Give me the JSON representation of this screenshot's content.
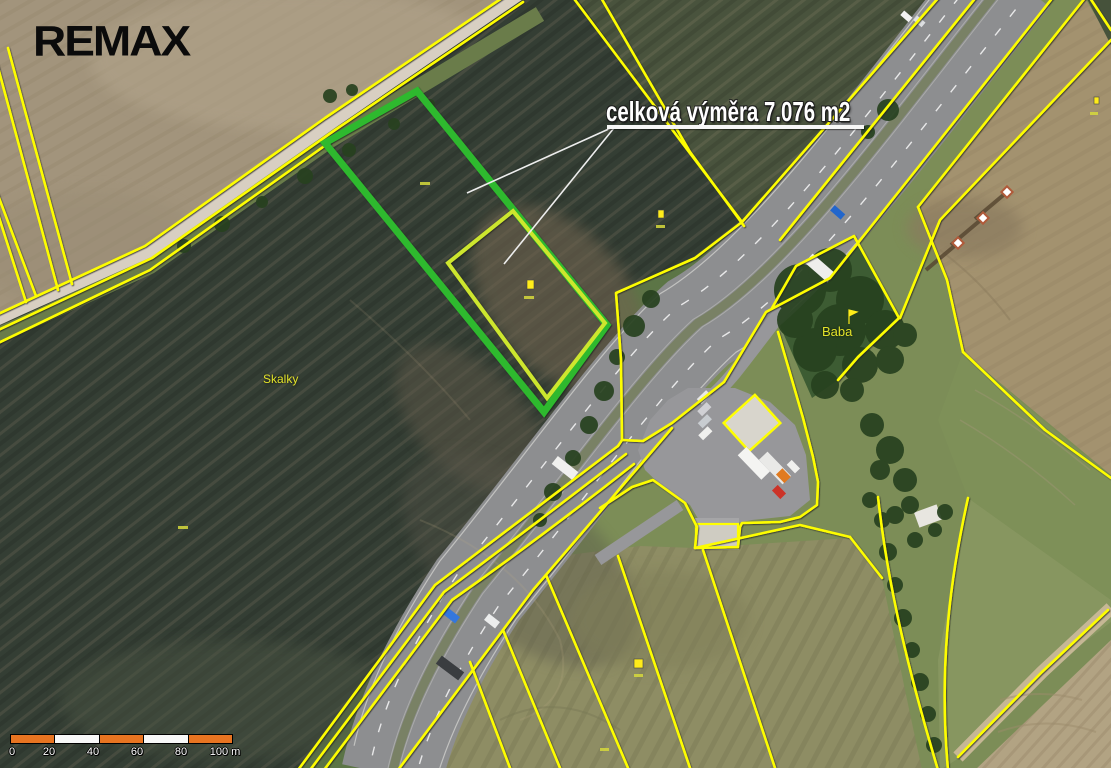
{
  "logo": {
    "text": "REMAX"
  },
  "annotation": {
    "text": "celková výměra 7.076 m2"
  },
  "place_labels": {
    "skalky": "Skalky",
    "baba": "Baba"
  },
  "scale_bar": {
    "tick_labels": [
      "0",
      "20",
      "40",
      "60",
      "80",
      "100 m"
    ],
    "segment_colors": [
      "#e87421",
      "#f8f8f8",
      "#e87421",
      "#f8f8f8",
      "#e87421"
    ]
  },
  "colors": {
    "cadastral_line": "#fdfd02",
    "highlight_parcel_outer": "#2db92d",
    "highlight_parcel_inner": "#cde62d",
    "annotation_text": "#ffffff",
    "annotation_underline": "#f7f7f7",
    "place_label": "#e3e32a",
    "scale_orange": "#e87421",
    "logo_black": "#0b0b0b"
  },
  "icons": {
    "parcel_flag_marker": "small yellow flag marker",
    "parcel_point_marker": "small yellow square marker"
  }
}
